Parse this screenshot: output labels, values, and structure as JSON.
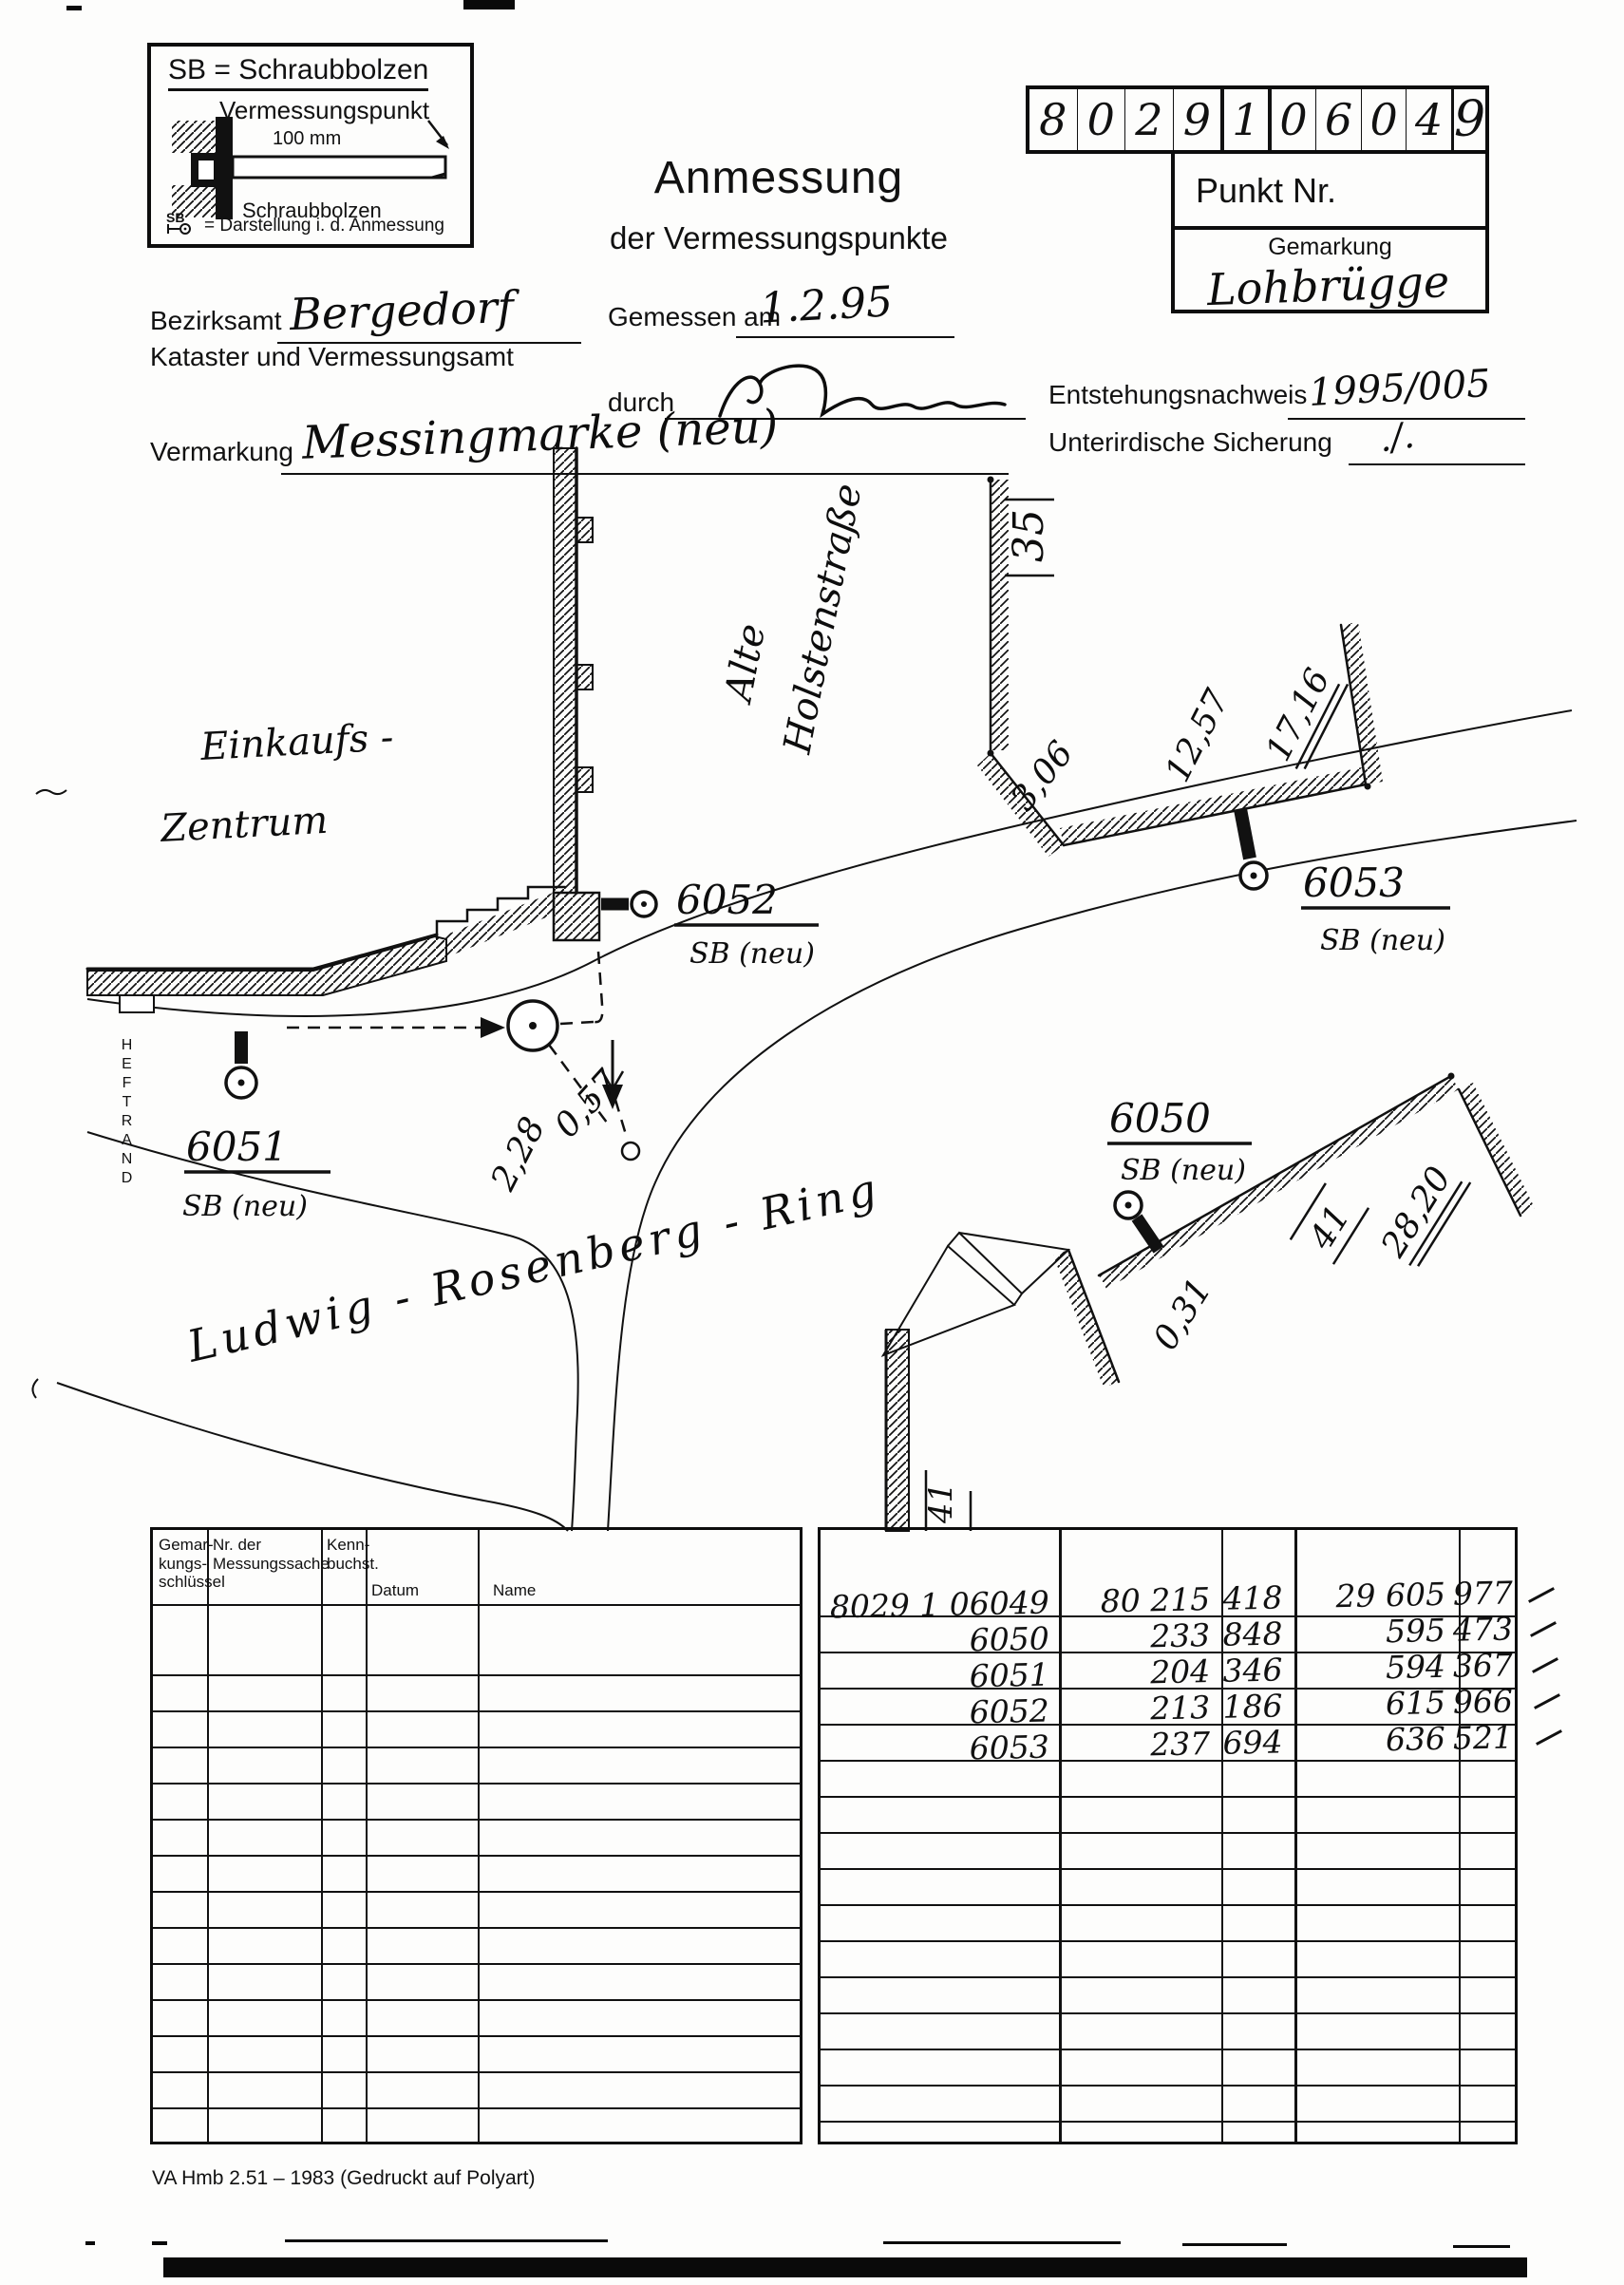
{
  "legend": {
    "title": "SB = Schraubbolzen",
    "subtitle": "Vermessungspunkt",
    "dimension": "100 mm",
    "bolt_label": "Schraubbolzen",
    "symbol_label": "SB",
    "symbol_note": "= Darstellung i. d. Anmessung"
  },
  "header": {
    "title": "Anmessung",
    "subtitle": "der Vermessungspunkte"
  },
  "punkt_grid": {
    "digits": [
      "8",
      "0",
      "2",
      "9",
      "1",
      "0",
      "6",
      "0",
      "4",
      "9"
    ],
    "label": "Punkt Nr.",
    "gemarkung_label": "Gemarkung",
    "gemarkung_value": "Lohbrügge"
  },
  "form": {
    "bezirksamt_label": "Bezirksamt",
    "bezirksamt_value": "Bergedorf",
    "amt_line": "Kataster und Vermessungsamt",
    "gemessen_label": "Gemessen am",
    "gemessen_value": "1.2.95",
    "durch_label": "durch",
    "entstehung_label": "Entstehungsnachweis",
    "entstehung_value": "1995/005",
    "vermarkung_label": "Vermarkung",
    "vermarkung_value": "Messingmarke (neu)",
    "sicherung_label": "Unterirdische Sicherung",
    "sicherung_value": "./."
  },
  "sketch": {
    "heftrand": "HEFTRAND",
    "streets": {
      "alte": "Alte",
      "holstenstrasse": "Holstenstraße",
      "ring": "Ludwig - Rosenberg - Ring"
    },
    "area": {
      "einkaufs": "Einkaufs -",
      "zentrum": "Zentrum"
    },
    "points": {
      "p6050": {
        "id": "6050",
        "type": "SB (neu)"
      },
      "p6051": {
        "id": "6051",
        "type": "SB (neu)"
      },
      "p6052": {
        "id": "6052",
        "type": "SB (neu)"
      },
      "p6053": {
        "id": "6053",
        "type": "SB (neu)"
      }
    },
    "measurements": {
      "m35": "35",
      "m3_06": "3,06",
      "m12_57": "12,57",
      "m17_16": "17,16",
      "m2_28": "2,28",
      "m0_57": "0,57",
      "m0_31": "0,31",
      "m28_20": "28,20",
      "m41_house": "41",
      "m41_street": "41"
    }
  },
  "left_table": {
    "headers": {
      "col1": "Gemar-\nkungs-\nschlüssel",
      "col2": "Nr. der\nMessungssache",
      "col3": "Kenn-\nbuchst.",
      "col4": "Datum",
      "col5": "Name"
    }
  },
  "right_table": {
    "rows": [
      {
        "point": "8029 1 06049",
        "x1": "80 215",
        "x2": "418",
        "y1": "29 605",
        "y2": "977"
      },
      {
        "point": "6050",
        "x1": "233",
        "x2": "848",
        "y1": "595",
        "y2": "473"
      },
      {
        "point": "6051",
        "x1": "204",
        "x2": "346",
        "y1": "594",
        "y2": "367"
      },
      {
        "point": "6052",
        "x1": "213",
        "x2": "186",
        "y1": "615",
        "y2": "966"
      },
      {
        "point": "6053",
        "x1": "237",
        "x2": "694",
        "y1": "636",
        "y2": "521"
      }
    ]
  },
  "footer": {
    "text": "VA Hmb 2.51 – 1983 (Gedruckt auf Polyart)"
  }
}
